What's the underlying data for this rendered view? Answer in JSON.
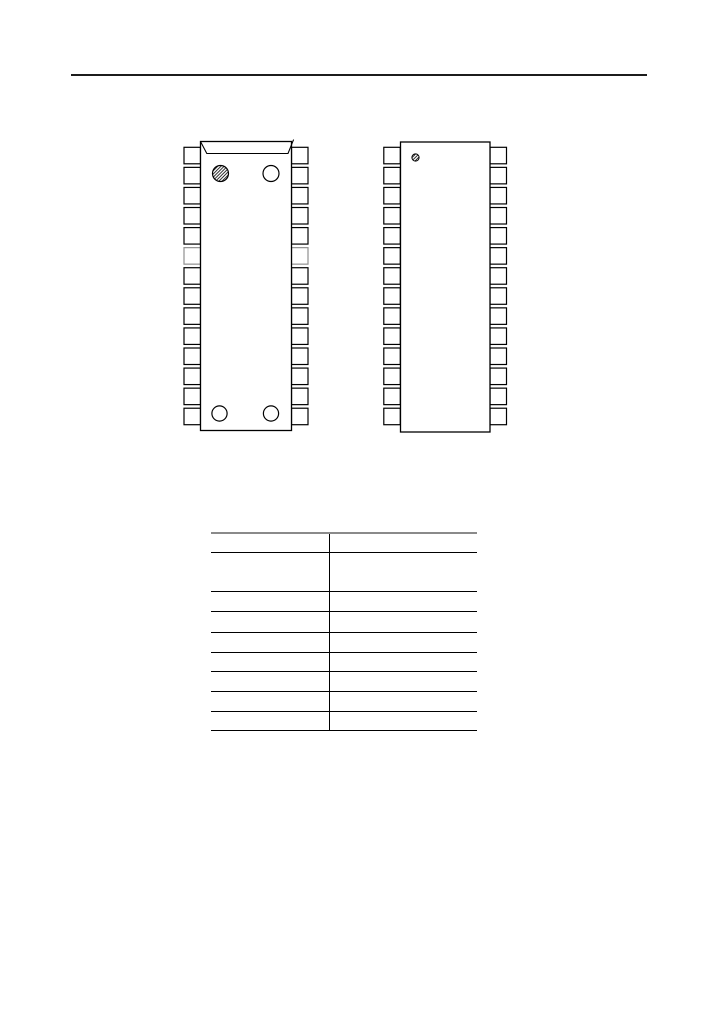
{
  "page": {
    "background": "#ffffff"
  },
  "top_rule": {
    "color": "#1c1c1c"
  },
  "figure": {
    "stroke_color": "#000000",
    "greyed_pin_color": "#8f8f8f",
    "packages": {
      "left": {
        "name": "dip-28-package-top-view",
        "pins_per_side": 14,
        "total_pins": 28,
        "pin1_marker": "hatched-circle",
        "open_circle_markers": 3,
        "greyed_pin_row": 6,
        "has_index_notch": true
      },
      "right": {
        "name": "dip-28-package-plain-view",
        "pins_per_side": 14,
        "total_pins": 28,
        "pin1_marker": "small-hatched-circle",
        "has_index_notch": false
      }
    }
  },
  "pin_table": {
    "columns": 2,
    "rows": 9,
    "top_border_color": "#8a8a8a",
    "line_color": "#000000",
    "cells": [
      [
        "",
        ""
      ],
      [
        "",
        ""
      ],
      [
        "",
        ""
      ],
      [
        "",
        ""
      ],
      [
        "",
        ""
      ],
      [
        "",
        ""
      ],
      [
        "",
        ""
      ],
      [
        "",
        ""
      ],
      [
        "",
        ""
      ]
    ]
  }
}
